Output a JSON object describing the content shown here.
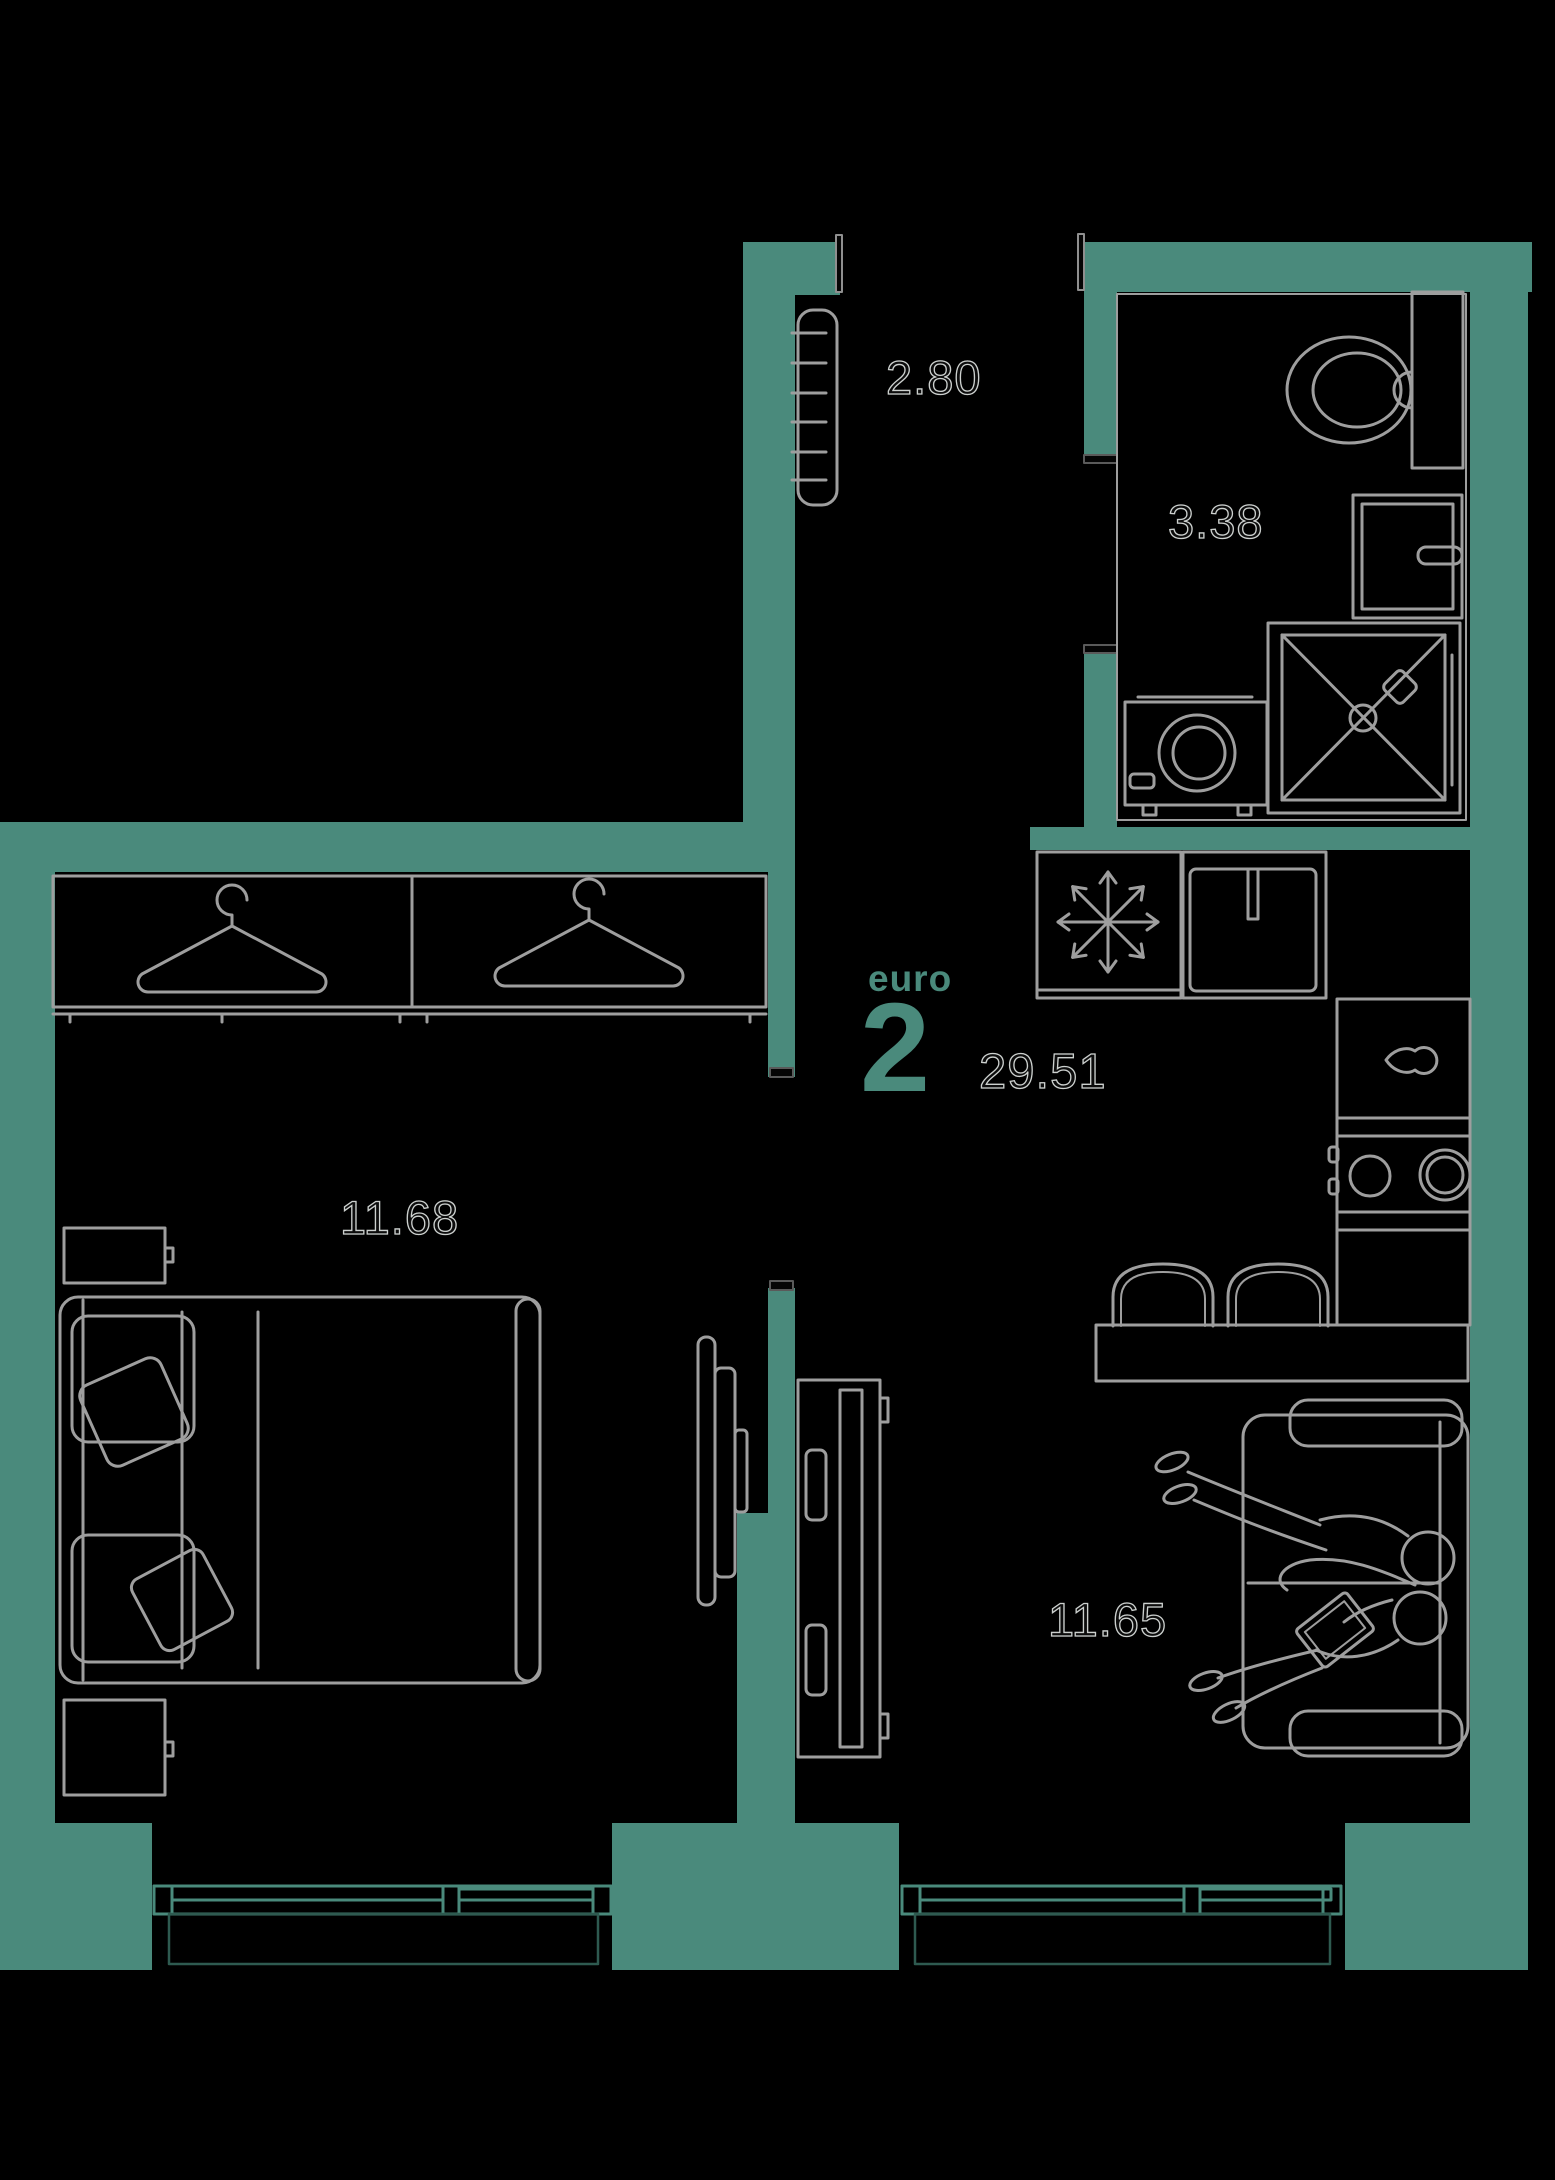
{
  "plan": {
    "background": "#000000",
    "wall_color": "#4A8A7C",
    "furniture_line_color": "#9E9E9E",
    "accent_color": "#4A8A7C",
    "unit": {
      "type_label": "euro",
      "rooms_count": "2",
      "total_area": "29.51"
    },
    "rooms": [
      {
        "name": "hallway",
        "area": "2.80"
      },
      {
        "name": "bathroom",
        "area": "3.38"
      },
      {
        "name": "bedroom",
        "area": "11.68"
      },
      {
        "name": "living-kitchen",
        "area": "11.65"
      }
    ],
    "icons": [
      "snowflake-icon",
      "hanger-icon",
      "drop-handle-icon"
    ]
  }
}
